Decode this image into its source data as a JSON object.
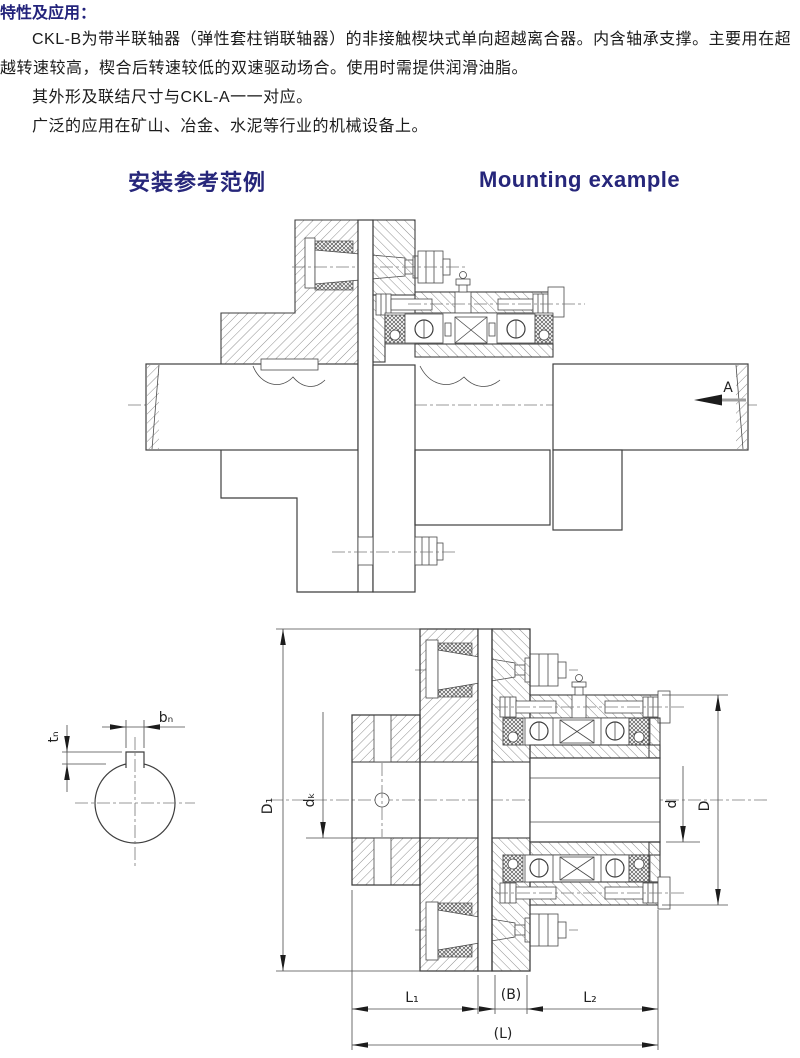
{
  "header": {
    "title": "特性及应用：",
    "paragraphs": [
      "CKL-B为带半联轴器（弹性套柱销联轴器）的非接触楔块式单向超越离合器。内含轴承支撑。主要用在超越转速较高，楔合后转速较低的双速驱动场合。使用时需提供润滑油脂。",
      "其外形及联结尺寸与CKL-A一一对应。",
      "广泛的应用在矿山、冶金、水泥等行业的机械设备上。"
    ]
  },
  "section": {
    "heading_zh": "安装参考范例",
    "heading_en": "Mounting example"
  },
  "diagram": {
    "view_label": "A",
    "dims": {
      "bn": "bₙ",
      "tn": "tₙ",
      "D1": "D₁",
      "dk": "dₖ",
      "d": "d",
      "D": "D",
      "L1": "L₁",
      "B": "(B)",
      "L2": "L₂",
      "L": "(L)"
    }
  },
  "colors": {
    "heading": "#26267a",
    "body": "#1b1b1b",
    "line": "#3f3f3f"
  }
}
